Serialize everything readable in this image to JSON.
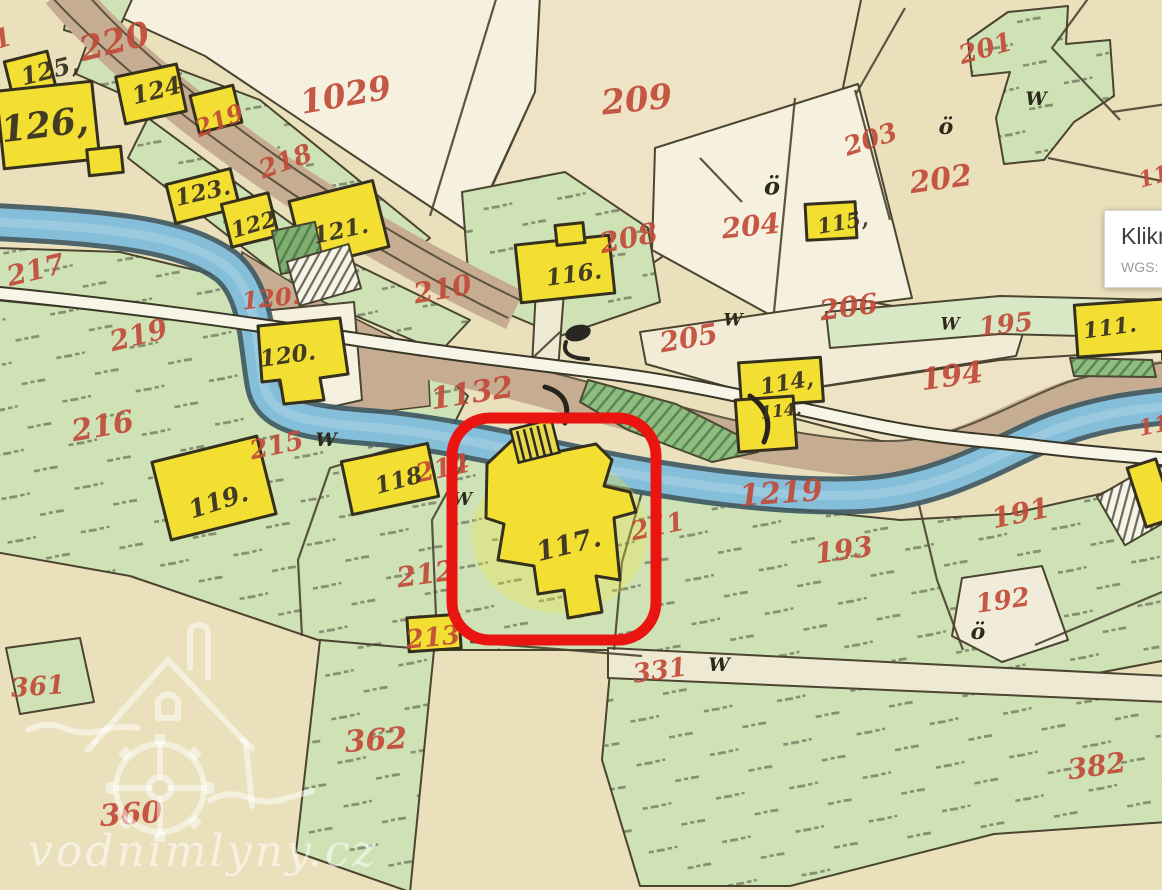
{
  "tooltip": {
    "title": "Klikni",
    "coords": "WGS: 50°"
  },
  "watermark": {
    "site": "vodnimlyny.cz"
  },
  "map": {
    "highlight": {
      "parcel": "117",
      "x": 452,
      "y": 418,
      "w": 204,
      "h": 222,
      "rx": 38,
      "color": "#ea1410",
      "stroke_width": 11
    },
    "colors": {
      "background": "#eae0bc",
      "parcel_green": "#cfe2b6",
      "building_yellow": "#f2df31",
      "river_blue": "#84bed9",
      "road_brown": "#c6ad92",
      "number_red": "#c14b39",
      "highlight_red": "#ea1410"
    },
    "red_labels": [
      {
        "t": "220",
        "x": 115,
        "y": 44,
        "s": 34,
        "r": -14
      },
      {
        "t": "1029",
        "x": 346,
        "y": 97,
        "s": 33,
        "r": -10
      },
      {
        "t": "209",
        "x": 637,
        "y": 102,
        "s": 34,
        "r": -6
      },
      {
        "t": "201",
        "x": 986,
        "y": 50,
        "s": 26,
        "r": -16
      },
      {
        "t": "203",
        "x": 871,
        "y": 141,
        "s": 26,
        "r": -18
      },
      {
        "t": "202",
        "x": 941,
        "y": 181,
        "s": 30,
        "r": -8
      },
      {
        "t": "204",
        "x": 751,
        "y": 228,
        "s": 28,
        "r": -6
      },
      {
        "t": "219",
        "x": 220,
        "y": 122,
        "s": 24,
        "r": -22
      },
      {
        "t": "218",
        "x": 286,
        "y": 163,
        "s": 26,
        "r": -20
      },
      {
        "t": "217",
        "x": 36,
        "y": 272,
        "s": 28,
        "r": -14
      },
      {
        "t": "219",
        "x": 139,
        "y": 337,
        "s": 28,
        "r": -14
      },
      {
        "t": "120.",
        "x": 271,
        "y": 300,
        "s": 24,
        "r": -6
      },
      {
        "t": "210",
        "x": 443,
        "y": 291,
        "s": 28,
        "r": -10
      },
      {
        "t": "208",
        "x": 629,
        "y": 240,
        "s": 28,
        "r": -12
      },
      {
        "t": "205",
        "x": 689,
        "y": 340,
        "s": 28,
        "r": -10
      },
      {
        "t": "206",
        "x": 849,
        "y": 309,
        "s": 28,
        "r": -8
      },
      {
        "t": "195",
        "x": 1006,
        "y": 326,
        "s": 26,
        "r": -6
      },
      {
        "t": "194",
        "x": 952,
        "y": 378,
        "s": 30,
        "r": -8
      },
      {
        "t": "1132",
        "x": 472,
        "y": 395,
        "s": 30,
        "r": -9
      },
      {
        "t": "216",
        "x": 103,
        "y": 428,
        "s": 30,
        "r": -10
      },
      {
        "t": "215",
        "x": 277,
        "y": 447,
        "s": 26,
        "r": -12
      },
      {
        "t": "214",
        "x": 443,
        "y": 470,
        "s": 26,
        "r": -12
      },
      {
        "t": "212",
        "x": 426,
        "y": 576,
        "s": 28,
        "r": -8
      },
      {
        "t": "213",
        "x": 433,
        "y": 639,
        "s": 26,
        "r": -6
      },
      {
        "t": "211",
        "x": 658,
        "y": 528,
        "s": 26,
        "r": -12
      },
      {
        "t": "1219",
        "x": 781,
        "y": 495,
        "s": 30,
        "r": -4
      },
      {
        "t": "193",
        "x": 844,
        "y": 552,
        "s": 28,
        "r": -8
      },
      {
        "t": "191",
        "x": 1021,
        "y": 515,
        "s": 28,
        "r": -12
      },
      {
        "t": "192",
        "x": 1003,
        "y": 602,
        "s": 26,
        "r": -8
      },
      {
        "t": "331",
        "x": 660,
        "y": 672,
        "s": 26,
        "r": -8
      },
      {
        "t": "361",
        "x": 38,
        "y": 688,
        "s": 26,
        "r": -4
      },
      {
        "t": "362",
        "x": 376,
        "y": 742,
        "s": 30,
        "r": -4
      },
      {
        "t": "360",
        "x": 131,
        "y": 816,
        "s": 30,
        "r": -4
      },
      {
        "t": "382",
        "x": 1097,
        "y": 768,
        "s": 28,
        "r": -8
      },
      {
        "t": "11",
        "x": 1154,
        "y": 178,
        "s": 22,
        "r": -15
      },
      {
        "t": "11",
        "x": 1154,
        "y": 427,
        "s": 22,
        "r": -12
      },
      {
        "t": "1",
        "x": 3,
        "y": 40,
        "s": 26,
        "r": -18
      }
    ],
    "black_labels": [
      {
        "t": "125,",
        "x": 50,
        "y": 72,
        "s": 24,
        "r": -14
      },
      {
        "t": "124",
        "x": 157,
        "y": 92,
        "s": 24,
        "r": -14
      },
      {
        "t": "126,",
        "x": 45,
        "y": 128,
        "s": 36,
        "r": -7
      },
      {
        "t": "123.",
        "x": 203,
        "y": 194,
        "s": 23,
        "r": -13
      },
      {
        "t": "122",
        "x": 254,
        "y": 226,
        "s": 22,
        "r": -16
      },
      {
        "t": "121.",
        "x": 341,
        "y": 232,
        "s": 23,
        "r": -12
      },
      {
        "t": "120.",
        "x": 288,
        "y": 357,
        "s": 23,
        "r": -8
      },
      {
        "t": "116.",
        "x": 574,
        "y": 276,
        "s": 23,
        "r": -8
      },
      {
        "t": "115,",
        "x": 843,
        "y": 224,
        "s": 21,
        "r": -10
      },
      {
        "t": "114,",
        "x": 787,
        "y": 384,
        "s": 22,
        "r": -10
      },
      {
        "t": "114.",
        "x": 781,
        "y": 412,
        "s": 17,
        "r": -6
      },
      {
        "t": "111.",
        "x": 1110,
        "y": 329,
        "s": 22,
        "r": -8
      },
      {
        "t": "118",
        "x": 399,
        "y": 482,
        "s": 23,
        "r": -15
      },
      {
        "t": "119.",
        "x": 219,
        "y": 503,
        "s": 25,
        "r": -18
      },
      {
        "t": "117.",
        "x": 569,
        "y": 546,
        "s": 27,
        "r": -14
      }
    ],
    "symbols": [
      {
        "t": "W",
        "x": 326,
        "y": 441,
        "s": 19
      },
      {
        "t": "W",
        "x": 733,
        "y": 321,
        "s": 17
      },
      {
        "t": "W",
        "x": 950,
        "y": 325,
        "s": 17
      },
      {
        "t": "W",
        "x": 1036,
        "y": 100,
        "s": 19
      },
      {
        "t": "W",
        "x": 462,
        "y": 500,
        "s": 18
      },
      {
        "t": "W",
        "x": 719,
        "y": 666,
        "s": 19
      },
      {
        "t": "ö",
        "x": 772,
        "y": 188,
        "s": 24
      },
      {
        "t": "ö",
        "x": 946,
        "y": 128,
        "s": 22
      },
      {
        "t": "ö",
        "x": 978,
        "y": 633,
        "s": 22
      }
    ]
  }
}
